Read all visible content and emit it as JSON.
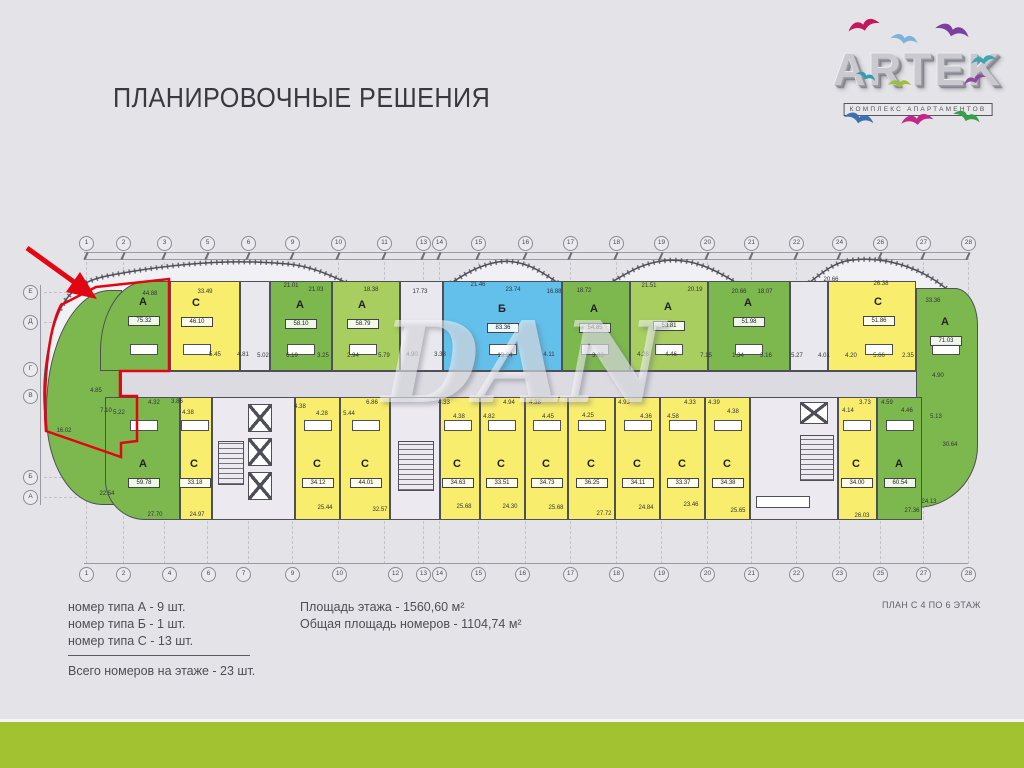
{
  "slide": {
    "title": "ПЛАНИРОВОЧНЫЕ РЕШЕНИЯ",
    "plan_caption": "ПЛАН С 4 ПО 6 ЭТАЖ",
    "watermark": "DAN"
  },
  "logo": {
    "name": "ARTEK",
    "subtitle": "КОМПЛЕКС АПАРТАМЕНТОВ",
    "birds": [
      {
        "x": 26,
        "y": 16,
        "s": 1.4,
        "r": -15,
        "c": "#c2185b"
      },
      {
        "x": 72,
        "y": 24,
        "s": 1.2,
        "r": 10,
        "c": "#7fb2d9"
      },
      {
        "x": 118,
        "y": 12,
        "s": 1.5,
        "r": 15,
        "c": "#7b3fa0"
      },
      {
        "x": 150,
        "y": 50,
        "s": 1.1,
        "r": -10,
        "c": "#3aa6b0"
      },
      {
        "x": 38,
        "y": 62,
        "s": 0.9,
        "r": 20,
        "c": "#2fa0ad"
      },
      {
        "x": 68,
        "y": 72,
        "s": 1.0,
        "r": 0,
        "c": "#9dbf3a"
      },
      {
        "x": 142,
        "y": 72,
        "s": 1.0,
        "r": -20,
        "c": "#8a4a9e"
      },
      {
        "x": 26,
        "y": 102,
        "s": 1.3,
        "r": 12,
        "c": "#3f6fae"
      },
      {
        "x": 80,
        "y": 108,
        "s": 1.4,
        "r": -8,
        "c": "#c2278c"
      },
      {
        "x": 136,
        "y": 100,
        "s": 1.2,
        "r": 18,
        "c": "#35a04a"
      }
    ]
  },
  "legend": {
    "type_lines": [
      "номер типа А - 9 шт.",
      "номер типа Б - 1 шт.",
      "номер типа С - 13 шт."
    ],
    "total_line": "Всего номеров на этаже - 23 шт.",
    "area_lines": [
      "Площадь этажа - 1560,60 м²",
      "Общая площадь номеров - 1104,74 м²"
    ]
  },
  "palette": {
    "bg": "#e4e3e7",
    "plan_fill": "#f1f0f4",
    "corridor": "#dcdbe2",
    "wall": "#4f4f57",
    "red": "#e20613",
    "bar_green": "#a3c232",
    "green": "#7db84f",
    "green_light": "#a7ce5f",
    "yellow": "#f8ed6d",
    "blue": "#63c0ea",
    "gray_room": "#e9e8ee"
  },
  "plan": {
    "grid_top": [
      {
        "n": "1",
        "x": 86
      },
      {
        "n": "2",
        "x": 123
      },
      {
        "n": "3",
        "x": 164
      },
      {
        "n": "5",
        "x": 207
      },
      {
        "n": "6",
        "x": 248
      },
      {
        "n": "9",
        "x": 292
      },
      {
        "n": "10",
        "x": 338
      },
      {
        "n": "11",
        "x": 384
      },
      {
        "n": "13",
        "x": 423
      },
      {
        "n": "14",
        "x": 439
      },
      {
        "n": "15",
        "x": 478
      },
      {
        "n": "16",
        "x": 525
      },
      {
        "n": "17",
        "x": 570
      },
      {
        "n": "18",
        "x": 616
      },
      {
        "n": "19",
        "x": 661
      },
      {
        "n": "20",
        "x": 707
      },
      {
        "n": "21",
        "x": 751
      },
      {
        "n": "22",
        "x": 796
      },
      {
        "n": "24",
        "x": 839
      },
      {
        "n": "26",
        "x": 880
      },
      {
        "n": "27",
        "x": 923
      },
      {
        "n": "28",
        "x": 968
      }
    ],
    "grid_bottom": [
      {
        "n": "1",
        "x": 86
      },
      {
        "n": "2",
        "x": 123
      },
      {
        "n": "4",
        "x": 169
      },
      {
        "n": "6",
        "x": 208
      },
      {
        "n": "7",
        "x": 243
      },
      {
        "n": "9",
        "x": 292
      },
      {
        "n": "10",
        "x": 339
      },
      {
        "n": "12",
        "x": 395
      },
      {
        "n": "13",
        "x": 423
      },
      {
        "n": "14",
        "x": 439
      },
      {
        "n": "15",
        "x": 478
      },
      {
        "n": "16",
        "x": 522
      },
      {
        "n": "17",
        "x": 570
      },
      {
        "n": "18",
        "x": 616
      },
      {
        "n": "19",
        "x": 661
      },
      {
        "n": "20",
        "x": 707
      },
      {
        "n": "21",
        "x": 751
      },
      {
        "n": "22",
        "x": 796
      },
      {
        "n": "23",
        "x": 839
      },
      {
        "n": "25",
        "x": 880
      },
      {
        "n": "27",
        "x": 923
      },
      {
        "n": "28",
        "x": 968
      }
    ],
    "grid_left": [
      {
        "n": "Е",
        "y": 292
      },
      {
        "n": "Д",
        "y": 322
      },
      {
        "n": "Г",
        "y": 369
      },
      {
        "n": "В",
        "y": 396
      },
      {
        "n": "Б",
        "y": 477
      },
      {
        "n": "А",
        "y": 497
      }
    ],
    "units": [
      {
        "row": "t",
        "x": 46,
        "y": 290,
        "w": 76,
        "h": 215,
        "fill": "green",
        "round": "64px 0 0 56px / 120px 0 0 90px"
      },
      {
        "row": "t",
        "x": 100,
        "w": 70,
        "fill": "green",
        "label": "А",
        "lx": 143,
        "ly": 303,
        "area": "75.32",
        "ax": 143,
        "ay": 320,
        "round": "46px 0 0 0 / 70px 0 0 0"
      },
      {
        "row": "t",
        "x": 170,
        "w": 70,
        "fill": "yellow",
        "label": "С",
        "lx": 196,
        "ly": 304,
        "area": "46.10",
        "ax": 196,
        "ay": 321
      },
      {
        "row": "t",
        "x": 240,
        "w": 30,
        "fill": "gray_room"
      },
      {
        "row": "t",
        "x": 270,
        "w": 62,
        "fill": "green",
        "label": "А",
        "lx": 300,
        "ly": 306,
        "area": "58.10",
        "ax": 300,
        "ay": 323
      },
      {
        "row": "t",
        "x": 332,
        "w": 68,
        "fill": "green_light",
        "label": "А",
        "lx": 362,
        "ly": 306,
        "area": "58.79",
        "ax": 362,
        "ay": 323
      },
      {
        "row": "t",
        "x": 400,
        "w": 43,
        "fill": "gray_room"
      },
      {
        "row": "t",
        "x": 443,
        "w": 119,
        "fill": "blue",
        "label": "Б",
        "lx": 502,
        "ly": 310,
        "area": "83.36",
        "ax": 502,
        "ay": 327
      },
      {
        "row": "t",
        "x": 562,
        "w": 68,
        "fill": "green",
        "label": "А",
        "lx": 594,
        "ly": 310,
        "area": "54.85",
        "ax": 594,
        "ay": 327
      },
      {
        "row": "t",
        "x": 630,
        "w": 78,
        "fill": "green_light",
        "label": "А",
        "lx": 668,
        "ly": 308,
        "area": "53.81",
        "ax": 668,
        "ay": 325
      },
      {
        "row": "t",
        "x": 708,
        "w": 82,
        "fill": "green",
        "label": "А",
        "lx": 748,
        "ly": 304,
        "area": "51.98",
        "ax": 748,
        "ay": 321
      },
      {
        "row": "t",
        "x": 790,
        "w": 38,
        "fill": "gray_room"
      },
      {
        "row": "t",
        "x": 828,
        "w": 88,
        "fill": "yellow",
        "label": "С",
        "lx": 878,
        "ly": 303,
        "area": "51.86",
        "ax": 878,
        "ay": 320
      },
      {
        "row": "t",
        "x": 916,
        "y": 288,
        "w": 62,
        "h": 220,
        "fill": "green",
        "label": "А",
        "lx": 945,
        "ly": 323,
        "area": "71.03",
        "ax": 945,
        "ay": 340,
        "round": "0 56px 150px 0 / 0 90px 150px 0"
      },
      {
        "row": "b",
        "x": 105,
        "w": 75,
        "fill": "green",
        "label": "А",
        "lx": 143,
        "ly": 465,
        "area": "59.78",
        "ax": 143,
        "ay": 482,
        "round": "0 0 0 40px"
      },
      {
        "row": "b",
        "x": 180,
        "w": 32,
        "fill": "yellow",
        "label": "С",
        "lx": 194,
        "ly": 465,
        "area": "33.18",
        "ax": 194,
        "ay": 482
      },
      {
        "row": "b",
        "x": 295,
        "w": 45,
        "fill": "yellow",
        "label": "С",
        "lx": 317,
        "ly": 465,
        "area": "34.12",
        "ax": 317,
        "ay": 482
      },
      {
        "row": "b",
        "x": 340,
        "w": 50,
        "fill": "yellow",
        "label": "С",
        "lx": 365,
        "ly": 465,
        "area": "44.01",
        "ax": 365,
        "ay": 482
      },
      {
        "row": "b",
        "x": 440,
        "w": 40,
        "fill": "yellow",
        "label": "С",
        "lx": 457,
        "ly": 465,
        "area": "34.63",
        "ax": 457,
        "ay": 482
      },
      {
        "row": "b",
        "x": 480,
        "w": 45,
        "fill": "yellow",
        "label": "С",
        "lx": 501,
        "ly": 465,
        "area": "33.51",
        "ax": 501,
        "ay": 482
      },
      {
        "row": "b",
        "x": 525,
        "w": 43,
        "fill": "yellow",
        "label": "С",
        "lx": 546,
        "ly": 465,
        "area": "34.73",
        "ax": 546,
        "ay": 482
      },
      {
        "row": "b",
        "x": 568,
        "w": 47,
        "fill": "yellow",
        "label": "С",
        "lx": 591,
        "ly": 465,
        "area": "36.25",
        "ax": 591,
        "ay": 482
      },
      {
        "row": "b",
        "x": 615,
        "w": 45,
        "fill": "yellow",
        "label": "С",
        "lx": 637,
        "ly": 465,
        "area": "34.11",
        "ax": 637,
        "ay": 482
      },
      {
        "row": "b",
        "x": 660,
        "w": 45,
        "fill": "yellow",
        "label": "С",
        "lx": 682,
        "ly": 465,
        "area": "33.37",
        "ax": 682,
        "ay": 482
      },
      {
        "row": "b",
        "x": 705,
        "w": 45,
        "fill": "yellow",
        "label": "С",
        "lx": 727,
        "ly": 465,
        "area": "34.38",
        "ax": 727,
        "ay": 482
      },
      {
        "row": "b",
        "x": 838,
        "w": 39,
        "fill": "yellow",
        "label": "С",
        "lx": 856,
        "ly": 465,
        "area": "34.00",
        "ax": 856,
        "ay": 482
      },
      {
        "row": "b",
        "x": 877,
        "w": 45,
        "fill": "green",
        "label": "А",
        "lx": 899,
        "ly": 465,
        "area": "60.54",
        "ax": 899,
        "ay": 482
      }
    ],
    "cores": [
      {
        "x": 212,
        "y": 397,
        "w": 83,
        "h": 123,
        "kind": "lift"
      },
      {
        "x": 390,
        "y": 397,
        "w": 50,
        "h": 123,
        "kind": "stair"
      },
      {
        "x": 750,
        "y": 397,
        "w": 88,
        "h": 123,
        "kind": "stair2"
      }
    ],
    "small_values": [
      [
        "44.88",
        150,
        295
      ],
      [
        "33.49",
        205,
        293
      ],
      [
        "21.01",
        291,
        287
      ],
      [
        "21.03",
        316,
        291
      ],
      [
        "18.38",
        371,
        291
      ],
      [
        "17.73",
        420,
        293
      ],
      [
        "21.46",
        478,
        286
      ],
      [
        "23.74",
        513,
        291
      ],
      [
        "16.88",
        554,
        293
      ],
      [
        "18.72",
        584,
        292
      ],
      [
        "21.51",
        649,
        287
      ],
      [
        "20.19",
        695,
        291
      ],
      [
        "20.66",
        739,
        293
      ],
      [
        "18.07",
        765,
        293
      ],
      [
        "20.66",
        831,
        281
      ],
      [
        "26.38",
        881,
        285
      ],
      [
        "33.36",
        933,
        302
      ],
      [
        "5.45",
        215,
        356
      ],
      [
        "4.81",
        243,
        356
      ],
      [
        "5.02",
        263,
        357
      ],
      [
        "6.19",
        292,
        357
      ],
      [
        "3.25",
        323,
        357
      ],
      [
        "2.94",
        353,
        357
      ],
      [
        "5.79",
        384,
        357
      ],
      [
        "4.90",
        412,
        356
      ],
      [
        "3.38",
        440,
        356
      ],
      [
        "13.24",
        505,
        357
      ],
      [
        "4.11",
        549,
        356
      ],
      [
        "3.83",
        598,
        357
      ],
      [
        "4.26",
        643,
        356
      ],
      [
        "4.46",
        671,
        356
      ],
      [
        "7.15",
        706,
        357
      ],
      [
        "1.34",
        738,
        357
      ],
      [
        "3.16",
        766,
        357
      ],
      [
        "5.27",
        797,
        357
      ],
      [
        "4.01",
        824,
        357
      ],
      [
        "4.20",
        851,
        357
      ],
      [
        "5.66",
        879,
        357
      ],
      [
        "2.35",
        908,
        357
      ],
      [
        "4.90",
        938,
        377
      ],
      [
        "4.85",
        96,
        392
      ],
      [
        "7.10",
        106,
        412
      ],
      [
        "5.22",
        119,
        414
      ],
      [
        "16.02",
        64,
        432
      ],
      [
        "4.32",
        154,
        404
      ],
      [
        "3.86",
        177,
        403
      ],
      [
        "4.38",
        188,
        414
      ],
      [
        "4.38",
        300,
        408
      ],
      [
        "4.28",
        322,
        415
      ],
      [
        "5.44",
        349,
        415
      ],
      [
        "6.86",
        372,
        404
      ],
      [
        "4.33",
        444,
        404
      ],
      [
        "4.38",
        459,
        418
      ],
      [
        "4.82",
        489,
        418
      ],
      [
        "4.94",
        509,
        404
      ],
      [
        "4.38",
        535,
        404
      ],
      [
        "4.45",
        548,
        418
      ],
      [
        "4.25",
        588,
        417
      ],
      [
        "4.93",
        624,
        404
      ],
      [
        "4.36",
        646,
        418
      ],
      [
        "4.58",
        673,
        418
      ],
      [
        "4.33",
        690,
        404
      ],
      [
        "4.39",
        714,
        404
      ],
      [
        "4.38",
        733,
        413
      ],
      [
        "3.73",
        865,
        404
      ],
      [
        "4.59",
        887,
        404
      ],
      [
        "4.14",
        848,
        412
      ],
      [
        "4.46",
        907,
        412
      ],
      [
        "5.13",
        936,
        418
      ],
      [
        "22.54",
        107,
        495
      ],
      [
        "27.70",
        155,
        516
      ],
      [
        "24.97",
        197,
        516
      ],
      [
        "25.44",
        325,
        509
      ],
      [
        "32.57",
        380,
        511
      ],
      [
        "25.68",
        464,
        508
      ],
      [
        "24.30",
        510,
        508
      ],
      [
        "25.68",
        556,
        509
      ],
      [
        "27.72",
        604,
        515
      ],
      [
        "24.84",
        646,
        509
      ],
      [
        "23.46",
        691,
        506
      ],
      [
        "25.65",
        738,
        512
      ],
      [
        "26.03",
        862,
        517
      ],
      [
        "27.36",
        912,
        512
      ],
      [
        "24.13",
        929,
        503
      ],
      [
        "30.64",
        950,
        446
      ]
    ]
  }
}
